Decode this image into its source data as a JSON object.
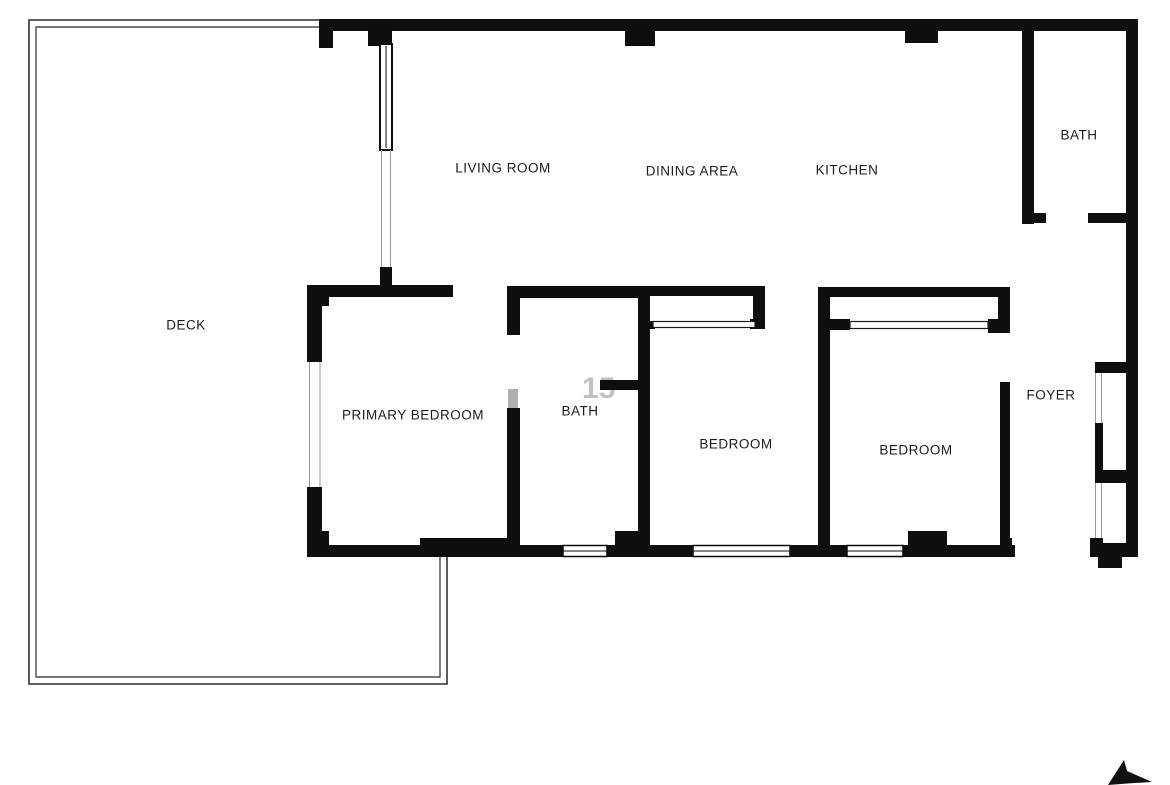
{
  "floorplan": {
    "title": "Apartment floor plan",
    "rooms": [
      {
        "id": "living-room",
        "label": "LIVING ROOM"
      },
      {
        "id": "dining-area",
        "label": "DINING AREA"
      },
      {
        "id": "kitchen",
        "label": "KITCHEN"
      },
      {
        "id": "bath-upper",
        "label": "BATH"
      },
      {
        "id": "deck",
        "label": "DECK"
      },
      {
        "id": "primary-bedroom",
        "label": "PRIMARY BEDROOM"
      },
      {
        "id": "bath-middle",
        "label": "BATH"
      },
      {
        "id": "bedroom-west",
        "label": "BEDROOM"
      },
      {
        "id": "bedroom-east",
        "label": "BEDROOM"
      },
      {
        "id": "foyer",
        "label": "FOYER"
      }
    ],
    "watermark_remnant": "15",
    "icons": {
      "compass": "north-arrow-icon"
    },
    "colors": {
      "wall": "#0e0e0e",
      "deck_outline": "#4a4a4a",
      "opening_line": "#9a9a9a",
      "door_leaf": "#b0b0b0",
      "label": "#1c1c1c",
      "background": "#ffffff"
    }
  }
}
